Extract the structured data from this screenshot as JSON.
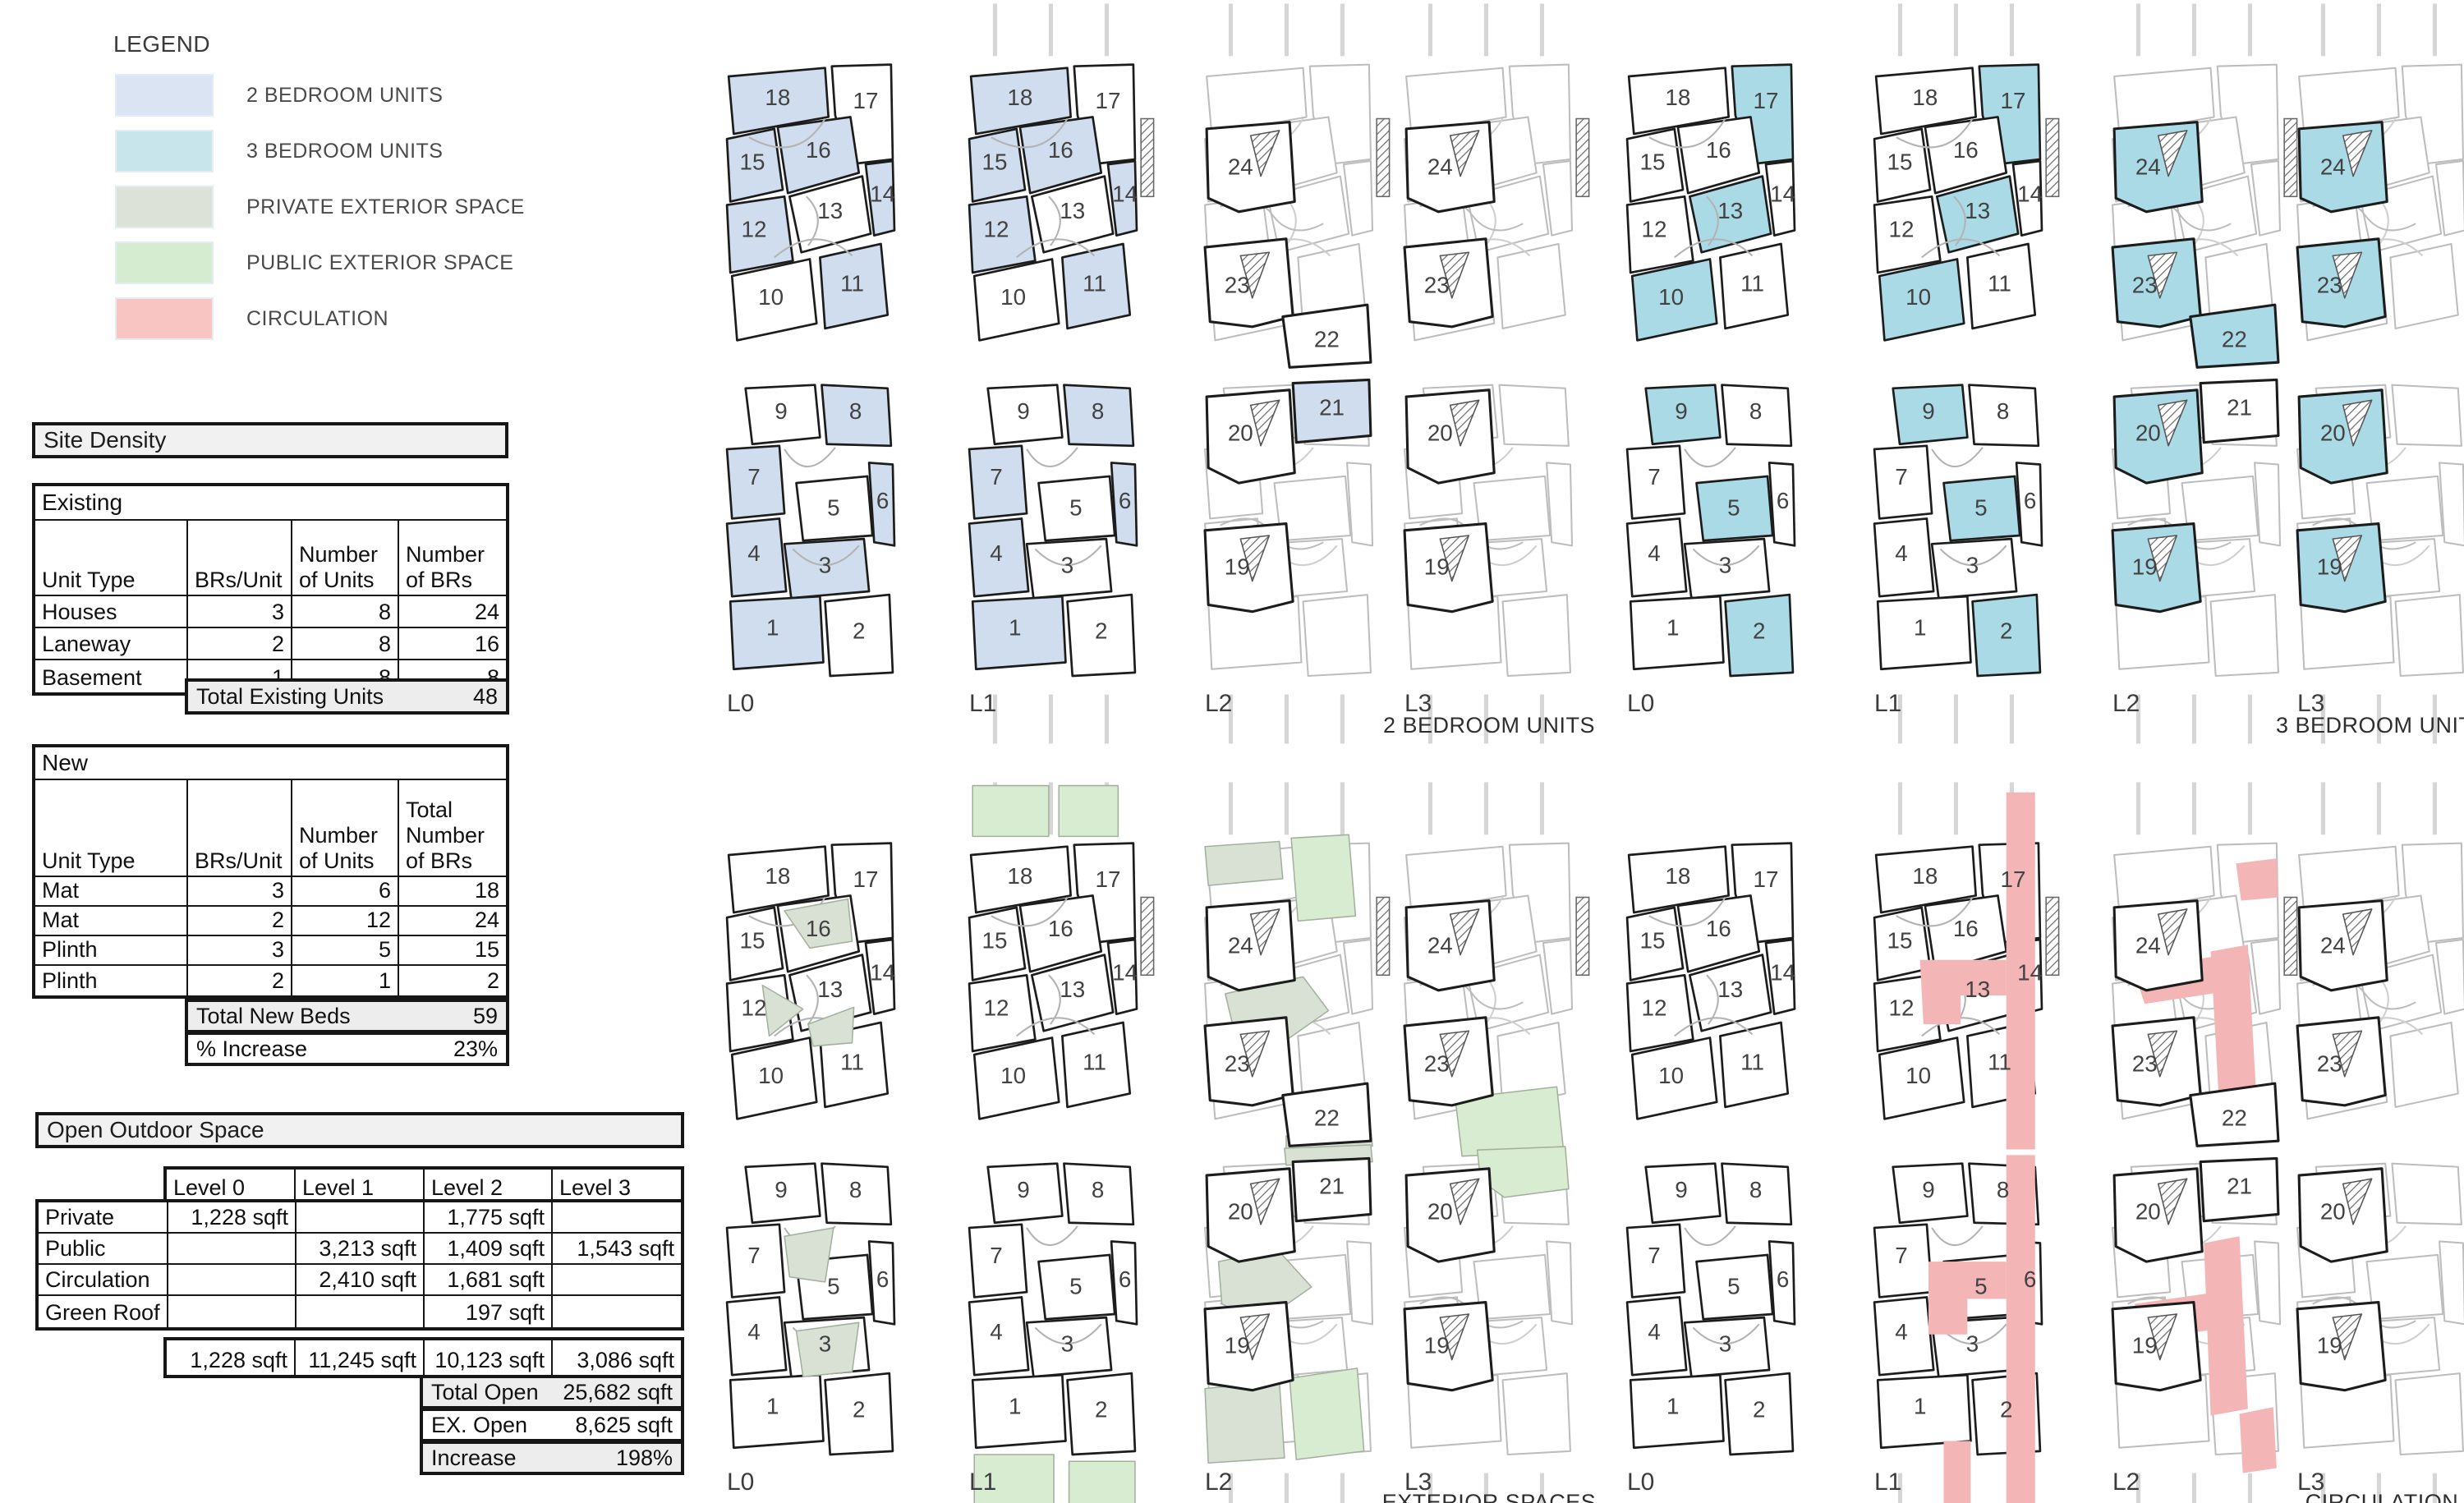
{
  "legend": {
    "title": "LEGEND",
    "items": [
      {
        "label": "2 BEDROOM UNITS",
        "color": "#dae4f2"
      },
      {
        "label": "3 BEDROOM UNITS",
        "color": "#c9e5ec"
      },
      {
        "label": "PRIVATE EXTERIOR SPACE",
        "color": "#dce2d8"
      },
      {
        "label": "PUBLIC EXTERIOR SPACE",
        "color": "#d6ecd1"
      },
      {
        "label": "CIRCULATION",
        "color": "#f9c5c2"
      }
    ]
  },
  "colors": {
    "unit2": "#cfddee",
    "unit3": "#a9dae6",
    "priv": "#d9e1d5",
    "pub": "#d8ecd2",
    "circ": "#f3b5b6"
  },
  "tables": {
    "site_density_title": "Site Density",
    "existing": {
      "title": "Existing",
      "columns": [
        "Unit Type",
        "BRs/Unit",
        "Number\nof Units",
        "Number\nof BRs"
      ],
      "rows": [
        [
          "Houses",
          "3",
          "8",
          "24"
        ],
        [
          "Laneway",
          "2",
          "8",
          "16"
        ],
        [
          "Basement",
          "1",
          "8",
          "8"
        ]
      ],
      "total_label": "Total Existing Units",
      "total_value": "48"
    },
    "new": {
      "title": "New",
      "columns": [
        "Unit Type",
        "BRs/Unit",
        "Number\nof Units",
        "Total\nNumber\nof BRs"
      ],
      "rows": [
        [
          "Mat",
          "3",
          "6",
          "18"
        ],
        [
          "Mat",
          "2",
          "12",
          "24"
        ],
        [
          "Plinth",
          "3",
          "5",
          "15"
        ],
        [
          "Plinth",
          "2",
          "1",
          "2"
        ]
      ],
      "total_beds_label": "Total New Beds",
      "total_beds_value": "59",
      "increase_label": "% Increase",
      "increase_value": "23%"
    },
    "open_outdoor": {
      "title": "Open Outdoor Space",
      "level_columns": [
        "Level 0",
        "Level 1",
        "Level 2",
        "Level 3"
      ],
      "rows": [
        [
          "Private",
          "1,228 sqft",
          "",
          "1,775 sqft",
          ""
        ],
        [
          "Public",
          "",
          "3,213 sqft",
          "1,409 sqft",
          "1,543 sqft"
        ],
        [
          "Circulation",
          "",
          "2,410 sqft",
          "1,681 sqft",
          ""
        ],
        [
          "Green Roof",
          "",
          "",
          "197 sqft",
          ""
        ]
      ],
      "totals": [
        "1,228 sqft",
        "11,245 sqft",
        "10,123 sqft",
        "3,086 sqft"
      ],
      "summary": [
        [
          "Total Open",
          "25,682 sqft"
        ],
        [
          "EX. Open",
          "8,625 sqft"
        ],
        [
          "Increase",
          "198%"
        ]
      ]
    }
  },
  "plans": {
    "upper_rooms": [
      18,
      17,
      15,
      16,
      13,
      14,
      12,
      10,
      11
    ],
    "lower_rooms": [
      9,
      8,
      7,
      5,
      6,
      4,
      3,
      2,
      1
    ],
    "upper_level_upper_rooms": [
      24,
      23,
      22
    ],
    "upper_level_lower_rooms": [
      20,
      21,
      19
    ],
    "groups": [
      {
        "caption": "2 BEDROOM UNITS",
        "fill": "unit2",
        "tiles": [
          {
            "level": "L0",
            "kind": "base",
            "fill_upper": [
              18,
              15,
              16,
              14,
              12,
              11
            ],
            "fill_lower": [
              8,
              7,
              6,
              4,
              3,
              1
            ]
          },
          {
            "level": "L1",
            "kind": "base",
            "context": true,
            "fill_upper": [
              18,
              15,
              16,
              14,
              12,
              11
            ],
            "fill_lower": [
              8,
              7,
              6,
              4,
              1
            ]
          },
          {
            "level": "L2",
            "kind": "upper",
            "context": true,
            "has_end_rooms": true,
            "fill_upper": [],
            "fill_lower": [
              21
            ],
            "bold_upper": [
              24,
              23,
              22
            ],
            "bold_lower": [
              20,
              21,
              19
            ]
          },
          {
            "level": "L3",
            "kind": "upper",
            "context": true,
            "has_end_rooms": false,
            "fill_upper": [],
            "fill_lower": [],
            "bold_upper": [
              24,
              23
            ],
            "bold_lower": [
              20,
              19
            ]
          }
        ]
      },
      {
        "caption": "3 BEDROOM UNITS",
        "fill": "unit3",
        "tiles": [
          {
            "level": "L0",
            "kind": "base",
            "fill_upper": [
              17,
              13,
              10
            ],
            "fill_lower": [
              9,
              5,
              2
            ]
          },
          {
            "level": "L1",
            "kind": "base",
            "context": true,
            "fill_upper": [
              17,
              13,
              10
            ],
            "fill_lower": [
              9,
              5,
              2
            ]
          },
          {
            "level": "L2",
            "kind": "upper",
            "context": true,
            "has_end_rooms": true,
            "fill_upper": [
              24,
              23,
              22
            ],
            "fill_lower": [
              20,
              19
            ],
            "bold_upper": [
              24,
              23,
              22
            ],
            "bold_lower": [
              20,
              21,
              19
            ]
          },
          {
            "level": "L3",
            "kind": "upper",
            "context": true,
            "has_end_rooms": false,
            "fill_upper": [
              24,
              23
            ],
            "fill_lower": [
              20,
              19
            ],
            "bold_upper": [
              24,
              23
            ],
            "bold_lower": [
              20,
              19
            ]
          }
        ]
      },
      {
        "caption": "EXTERIOR SPACES",
        "fill": "unit2",
        "tiles": [
          {
            "level": "L0",
            "kind": "base",
            "overlays_upper": [
              "exL0U"
            ],
            "overlays_lower": [
              "exL0L"
            ]
          },
          {
            "level": "L1",
            "kind": "base",
            "context": true,
            "overlays_upper": [
              "exL1U"
            ],
            "overlays_lower": [
              "exL1L"
            ]
          },
          {
            "level": "L2",
            "kind": "upper",
            "context": true,
            "has_end_rooms": true,
            "bold_upper": [
              24,
              23,
              22
            ],
            "bold_lower": [
              20,
              21,
              19
            ],
            "overlays_upper": [
              "exL2U"
            ],
            "overlays_lower": [
              "exL2L"
            ]
          },
          {
            "level": "L3",
            "kind": "upper",
            "context": true,
            "has_end_rooms": false,
            "bold_upper": [
              24,
              23
            ],
            "bold_lower": [
              20,
              19
            ],
            "overlays_upper": [
              "exL3U"
            ],
            "overlays_lower": [
              "exL3L"
            ]
          }
        ]
      },
      {
        "caption": "CIRCULATION",
        "fill": "circ",
        "tiles": [
          {
            "level": "L0",
            "kind": "base"
          },
          {
            "level": "L1",
            "kind": "base",
            "context": true,
            "overlays_upper": [
              "ciL1U"
            ],
            "overlays_lower": [
              "ciL1L"
            ]
          },
          {
            "level": "L2",
            "kind": "upper",
            "context": true,
            "has_end_rooms": true,
            "bold_upper": [
              24,
              23,
              22
            ],
            "bold_lower": [
              20,
              21,
              19
            ],
            "overlays_upper": [
              "ciL2U"
            ],
            "overlays_lower": [
              "ciL2L"
            ]
          },
          {
            "level": "L3",
            "kind": "upper",
            "context": true,
            "has_end_rooms": false,
            "bold_upper": [
              24,
              23
            ],
            "bold_lower": [
              20,
              19
            ]
          }
        ]
      }
    ]
  }
}
